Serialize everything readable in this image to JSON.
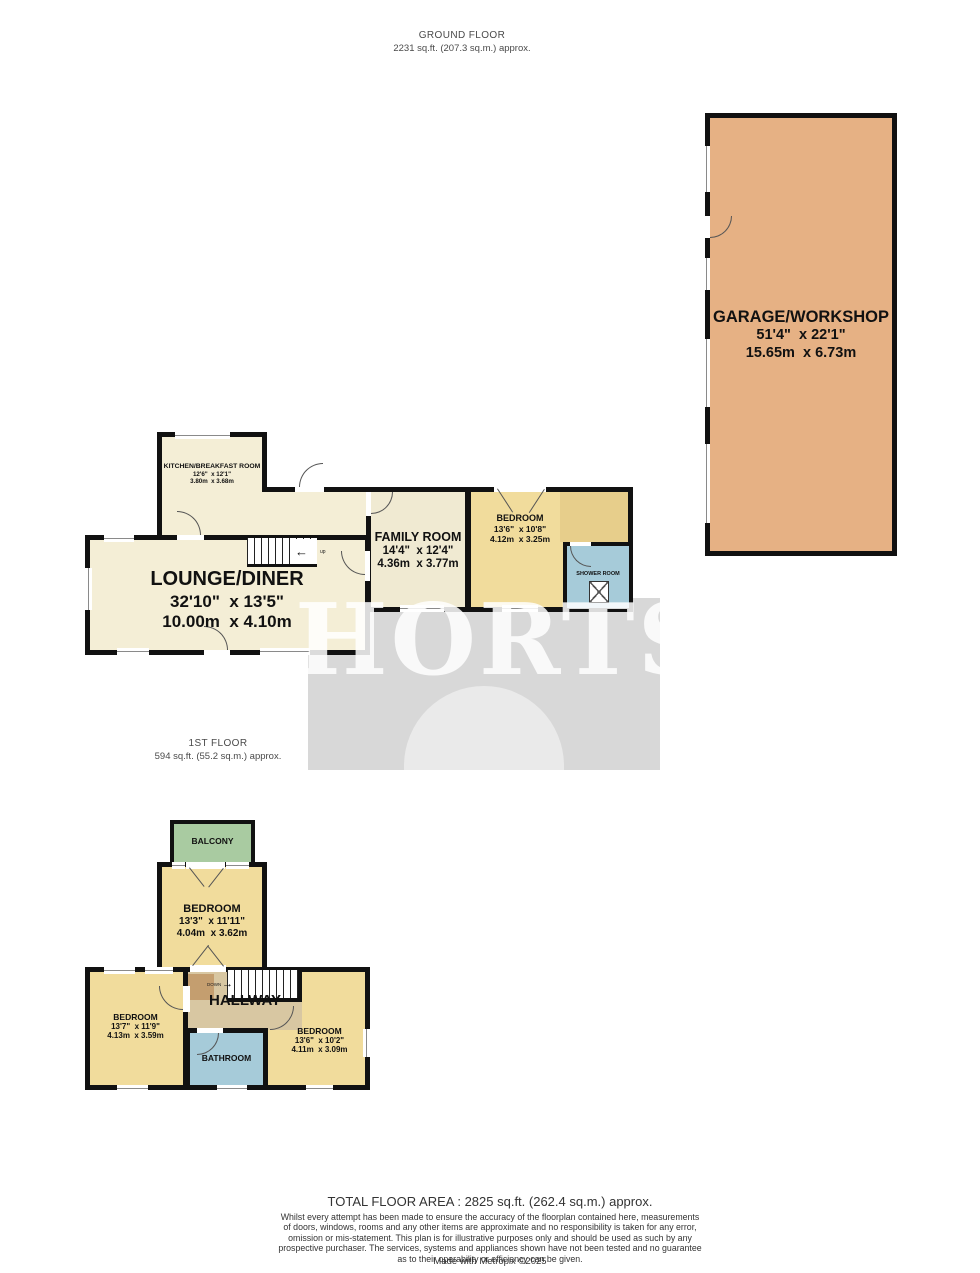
{
  "header": {
    "floor": "GROUND FLOOR",
    "area": "2231 sq.ft. (207.3 sq.m.) approx."
  },
  "first_floor_header": {
    "floor": "1ST FLOOR",
    "area": "594 sq.ft. (55.2 sq.m.) approx."
  },
  "watermark": "HORTS",
  "ground_floor": {
    "garage": {
      "name": "GARAGE/WORKSHOP",
      "imperial": "51'4\"  x 22'1\"",
      "metric": "15.65m  x 6.73m"
    },
    "kitchen": {
      "name": "KITCHEN/BREAKFAST ROOM",
      "imperial": "12'6\"  x 12'1\"",
      "metric": "3.80m  x 3.68m"
    },
    "lounge": {
      "name": "LOUNGE/DINER",
      "imperial": "32'10\"  x 13'5\"",
      "metric": "10.00m  x 4.10m"
    },
    "family": {
      "name": "FAMILY ROOM",
      "imperial": "14'4\"  x 12'4\"",
      "metric": "4.36m  x 3.77m"
    },
    "bedroom": {
      "name": "BEDROOM",
      "imperial": "13'6\"  x 10'8\"",
      "metric": "4.12m  x 3.25m"
    },
    "shower": {
      "name": "SHOWER ROOM"
    },
    "stairs_label": "up",
    "stairs_arrow": "←"
  },
  "first_floor": {
    "balcony": {
      "name": "BALCONY"
    },
    "bedroom_middle": {
      "name": "BEDROOM",
      "imperial": "13'3\"  x 11'11\"",
      "metric": "4.04m  x 3.62m"
    },
    "bedroom_left": {
      "name": "BEDROOM",
      "imperial": "13'7\"  x 11'9\"",
      "metric": "4.13m  x 3.59m"
    },
    "bedroom_right": {
      "name": "BEDROOM",
      "imperial": "13'6\"  x 10'2\"",
      "metric": "4.11m  x 3.09m"
    },
    "hallway": {
      "name": "HALLWAY"
    },
    "bathroom": {
      "name": "BATHROOM"
    },
    "stairs_label": "DOWN",
    "stairs_arrow": "→"
  },
  "footer": {
    "total": "TOTAL FLOOR AREA : 2825 sq.ft. (262.4 sq.m.) approx.",
    "disclaimer_lines": [
      "Whilst every attempt has been made to ensure the accuracy of the floorplan contained here, measurements",
      "of doors, windows, rooms and any other items are approximate and no responsibility is taken for any error,",
      "omission or mis-statement. This plan is for illustrative purposes only and should be used as such by any",
      "prospective purchaser. The services, systems and appliances shown have not been tested and no guarantee",
      "as to their operability or efficiency can be given."
    ],
    "credit": "Made with Metropix ©2025"
  },
  "colors": {
    "wall": "#111111",
    "cream": "#F4EED6",
    "yellow": "#F1DC9C",
    "yellow_dark": "#E7CE8B",
    "blue": "#A6CBD9",
    "green": "#A9CBA1",
    "hallway_tan": "#D8C7A2",
    "hallway_brown": "#C49E6F",
    "garage_salmon": "#E6B184",
    "watermark_gray": "#D8D8D8"
  }
}
